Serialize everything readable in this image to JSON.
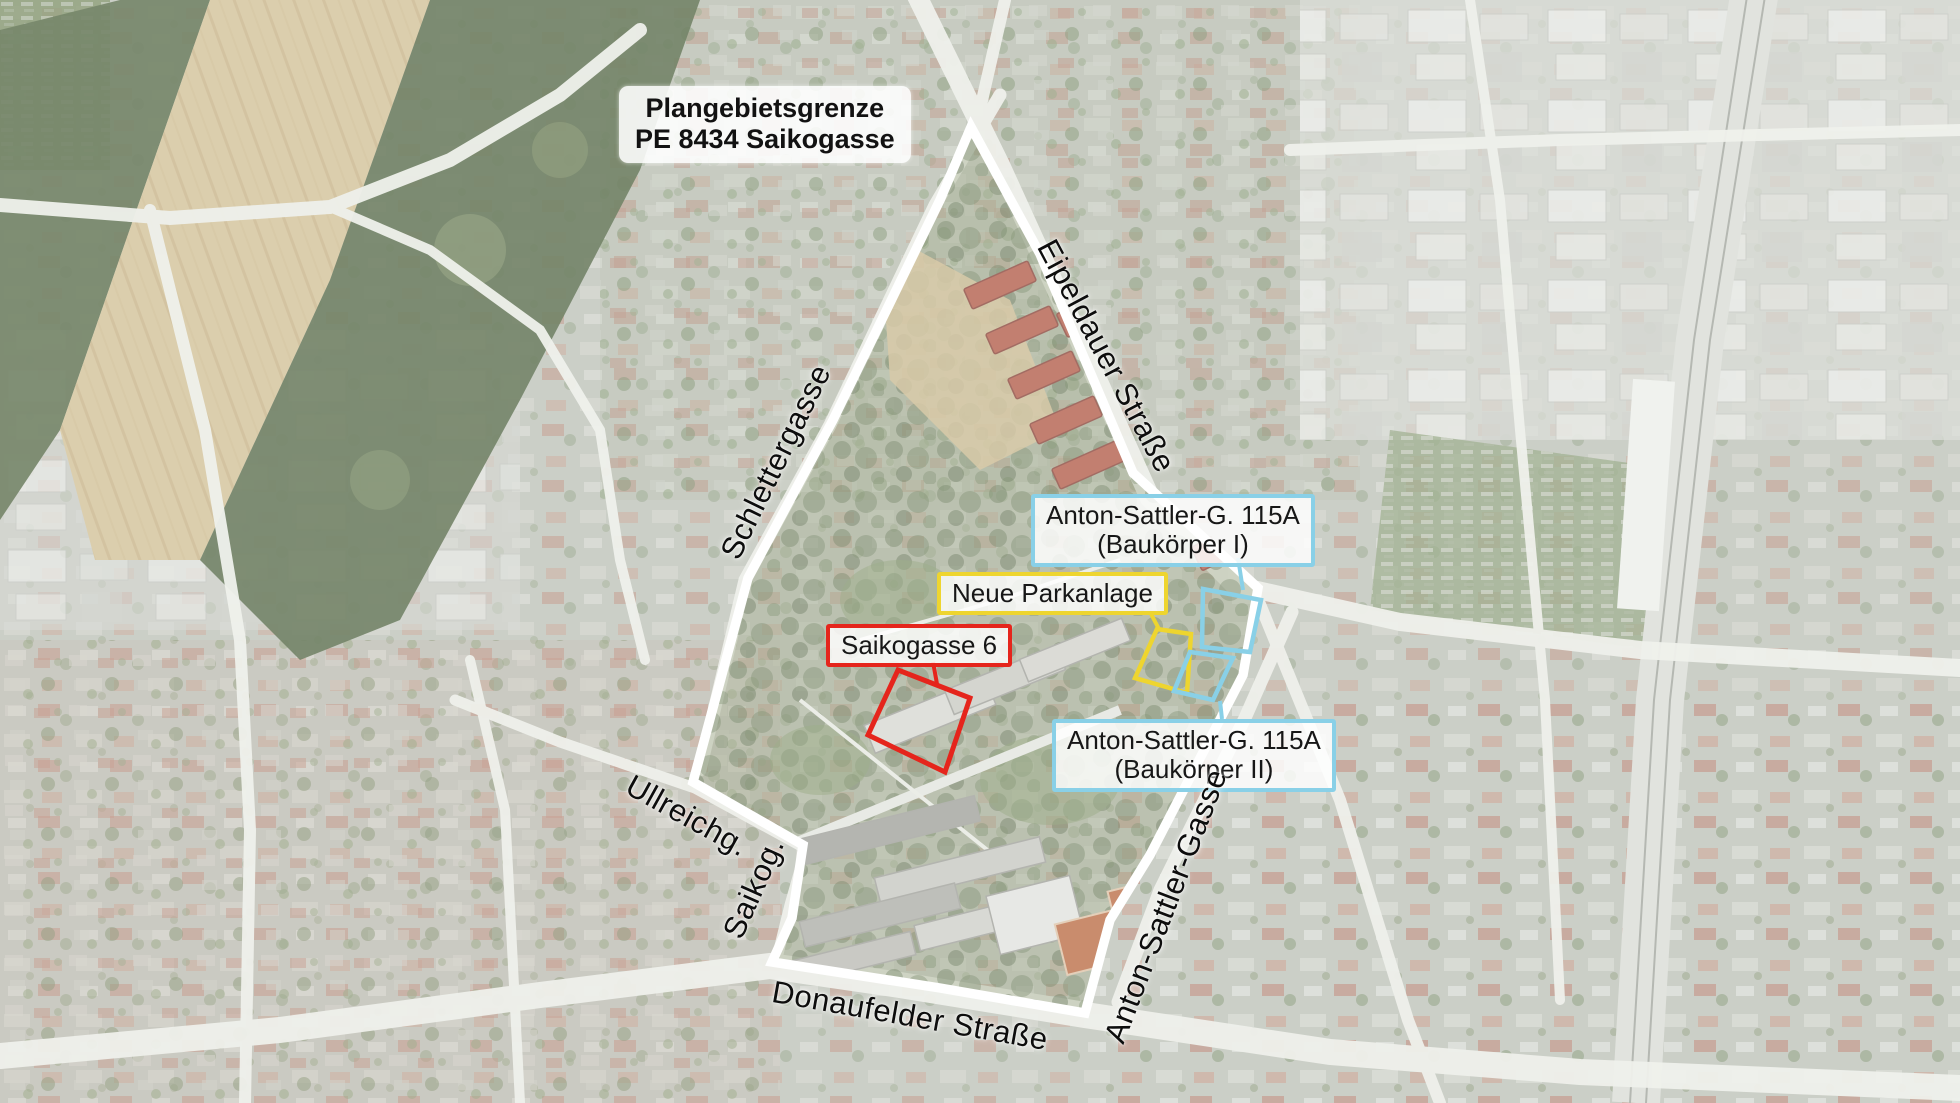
{
  "title_box": {
    "line1": "Plangebietsgrenze",
    "line2": "PE 8434 Saikogasse"
  },
  "callouts": {
    "baukoerper_i": {
      "line1": "Anton-Sattler-G. 115A",
      "line2": "(Baukörper I)",
      "color": "#89d0e7"
    },
    "neue_parkanlage": {
      "label": "Neue Parkanlage",
      "color": "#eed52f"
    },
    "saikogasse_6": {
      "label": "Saikogasse 6",
      "color": "#e5251c"
    },
    "baukoerper_ii": {
      "line1": "Anton-Sattler-G. 115A",
      "line2": "(Baukörper II)",
      "color": "#89d0e7"
    }
  },
  "streets": {
    "schlettergasse": "Schlettergasse",
    "eipeldauer": "Eipeldauer Straße",
    "ullreichgasse": "Ullreichg.",
    "saikogasse": "Saikog.",
    "donaufelder": "Donaufelder Straße",
    "anton_sattler": "Anton-Sattler-Gasse"
  },
  "colors": {
    "boundary": "#ffffff",
    "highlight_red": "#e5251c",
    "highlight_yellow": "#eed52f",
    "highlight_blue": "#89d0e7"
  }
}
